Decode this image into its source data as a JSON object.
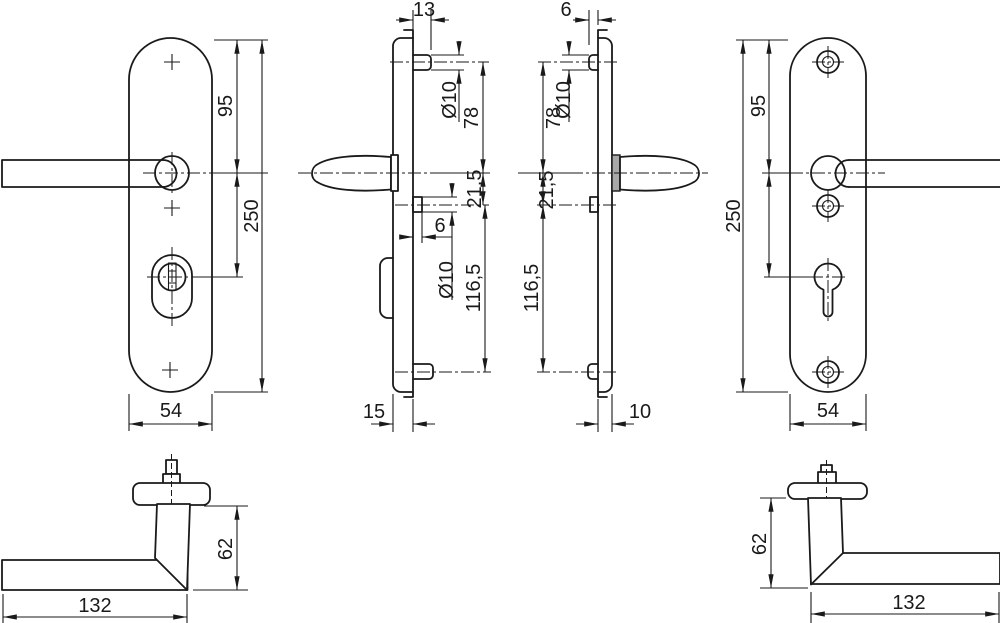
{
  "drawing": {
    "type": "technical-drawing",
    "subject": "door security fitting set - lever handles on plates, four orthographic plate views and two handle profile views",
    "colors": {
      "line": "#1a1a1a",
      "background": "#ffffff",
      "handle_neck_fill": "#a8a8a8"
    },
    "views": {
      "plate_exterior_front": {
        "dims": {
          "top_to_handle": "95",
          "total_height": "250",
          "width": "54"
        }
      },
      "plate_exterior_side": {
        "dims": {
          "stud_length_top": "13",
          "stud_dia_top": "Ø10",
          "stud_to_handle": "78",
          "handle_to_stud": "21,5",
          "stud_length_mid": "6",
          "stud_dia_mid": "Ø10",
          "stud_spacing": "116,5",
          "thickness": "15"
        }
      },
      "plate_interior_side": {
        "dims": {
          "stud_length_top": "6",
          "stud_dia_top": "Ø10",
          "stud_to_handle": "78",
          "handle_to_stud": "21,5",
          "stud_spacing": "116,5",
          "thickness": "10"
        }
      },
      "plate_interior_front": {
        "dims": {
          "top_to_handle": "95",
          "total_height": "250",
          "width": "54"
        }
      },
      "handle_profile_left": {
        "dims": {
          "height": "62",
          "length": "132"
        }
      },
      "handle_profile_right": {
        "dims": {
          "height": "62",
          "length": "132"
        }
      }
    }
  }
}
